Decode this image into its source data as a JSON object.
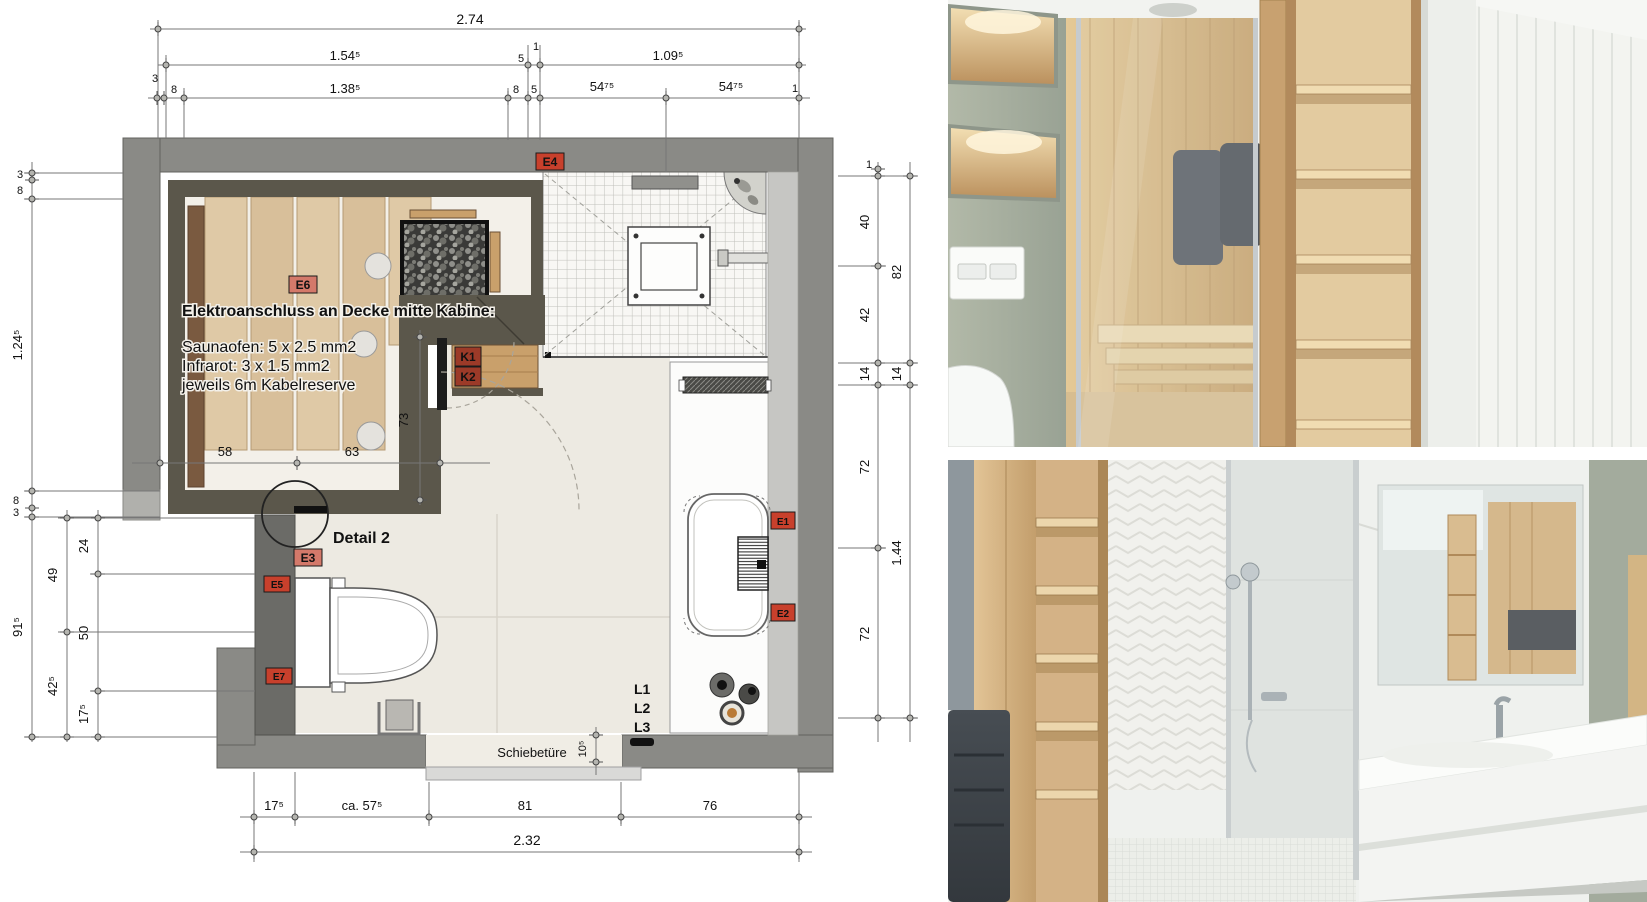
{
  "floorplan": {
    "note": {
      "title": "Elektroanschluss an Decke mitte Kabine:",
      "line1": "Saunaofen: 5 x 2.5 mm2",
      "line2": "Infrarot: 3 x 1.5 mm2",
      "line3": "jeweils 6m Kabelreserve"
    },
    "labels": {
      "detail": "Detail 2",
      "door": "Schiebetüre",
      "l1": "L1",
      "l2": "L2",
      "l3": "L3"
    },
    "tags": {
      "e1": "E1",
      "e2": "E2",
      "e3": "E3",
      "e4": "E4",
      "e5": "E5",
      "e6": "E6",
      "e7": "E7",
      "k1": "K1",
      "k2": "K2"
    },
    "dims": {
      "top": {
        "overall": "2.74",
        "seg154": "1.54⁵",
        "seg1a": "1",
        "seg5a": "5",
        "seg109": "1.09⁵",
        "seg3": "3",
        "seg8a": "8",
        "seg138": "1.38⁵",
        "seg8b": "8",
        "seg5b": "5",
        "seg5475a": "54⁷⁵",
        "seg5475b": "54⁷⁵",
        "seg1b": "1"
      },
      "left": {
        "seg3a": "3",
        "seg8a": "8",
        "seg124": "1.24⁵",
        "seg8b": "8",
        "seg3b": "3",
        "seg915": "91⁵",
        "seg49": "49",
        "seg425": "42⁵",
        "seg24": "24",
        "seg50": "50",
        "seg175": "17⁵"
      },
      "right": {
        "seg1": "1",
        "seg40": "40",
        "seg42": "42",
        "seg14a": "14",
        "seg72a": "72",
        "seg72b": "72",
        "seg82": "82",
        "seg14b": "14",
        "seg144": "1.44"
      },
      "bottom": {
        "seg175": "17⁵",
        "segca575": "ca. 57⁵",
        "seg81": "81",
        "seg76": "76",
        "overall": "2.32"
      },
      "inner": {
        "seg58": "58",
        "seg63": "63",
        "seg73": "73",
        "seg105": "10⁵"
      }
    },
    "colors": {
      "outer_wall": "#8a8a86",
      "toilet_wall": "#6b6b67",
      "sauna_wall": "#5b574b",
      "wood_bench": "#dfc9a6",
      "wood_plank": "#7a5a40",
      "floor": "#edeae2",
      "tag_red_bg": "#c8402c",
      "tag_salmon_bg": "#d4796a",
      "tag_dark_bg": "#9c3a28",
      "tag_text_red": "#e81e00"
    }
  },
  "photos": {
    "sauna_render": {
      "colors": {
        "sage_wall": "#a9b1a1",
        "wood": "#d9bc92",
        "towel": "#5b5f65",
        "tile": "#f3f4f0"
      }
    },
    "bathroom_render": {
      "colors": {
        "wood": "#d9ba8e",
        "heater": "#3f454b",
        "glass": "#c9cecf",
        "vanity": "#fbfcfa",
        "sage_wall": "#a3ab9d"
      }
    }
  }
}
